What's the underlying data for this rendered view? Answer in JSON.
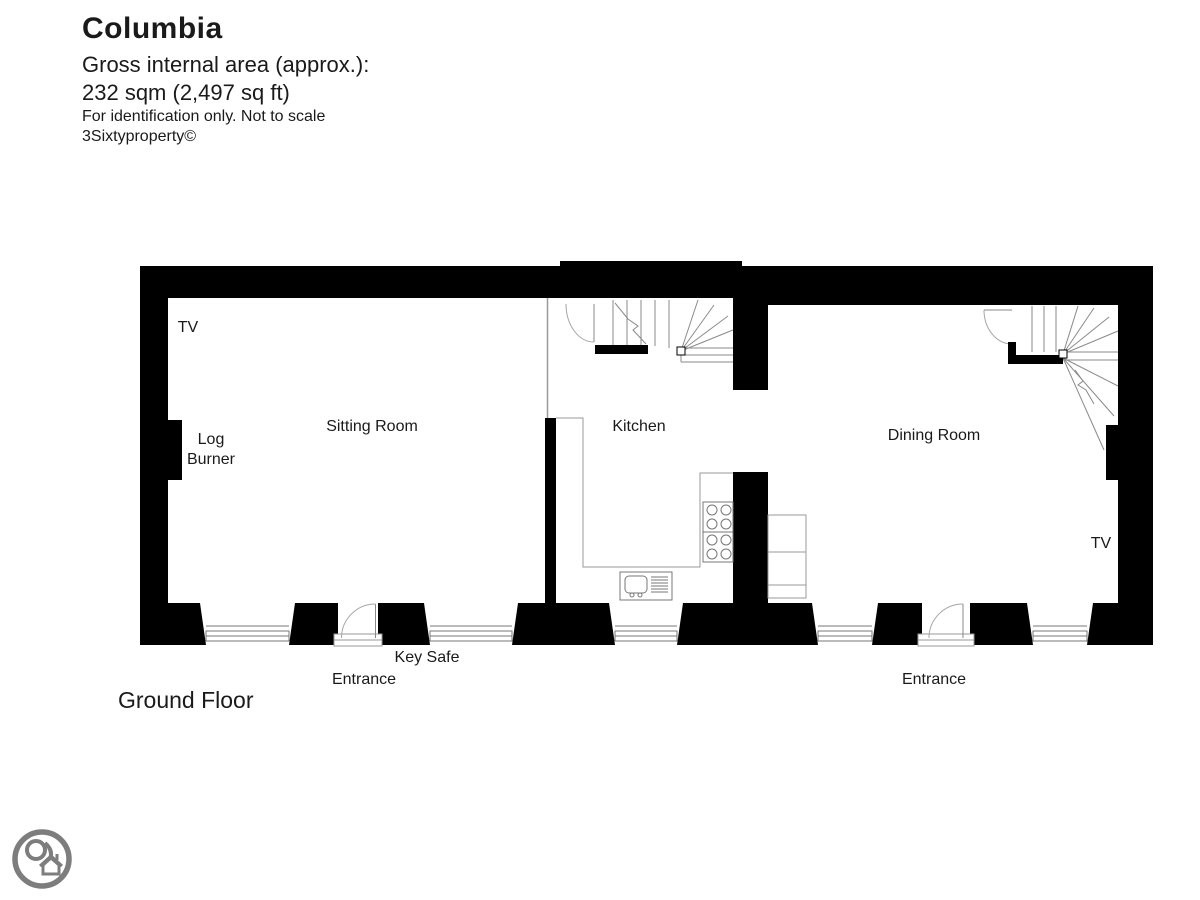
{
  "header": {
    "title": "Columbia",
    "subtitle_line1": "Gross internal area (approx.):",
    "subtitle_line2": "232 sqm (2,497 sq ft)",
    "note_line1": "For identification only. Not to scale",
    "note_line2": "3Sixtyproperty©"
  },
  "floor_label": "Ground Floor",
  "rooms": [
    {
      "name": "Sitting Room"
    },
    {
      "name": "Kitchen"
    },
    {
      "name": "Dining Room"
    }
  ],
  "annotations": {
    "tv_sitting": "TV",
    "log_burner_line1": "Log",
    "log_burner_line2": "Burner",
    "key_safe": "Key Safe",
    "entrance_left": "Entrance",
    "entrance_right": "Entrance",
    "tv_dining": "TV"
  },
  "logo": {
    "icon": "house-location-pin-badge"
  },
  "colors": {
    "wall": "#000000",
    "fixture_line": "#777777",
    "stair_line": "#8a8a8a",
    "arc_line": "#a6a6a6",
    "text": "#1a1a1a",
    "logo_gray": "#7d7d7d"
  }
}
